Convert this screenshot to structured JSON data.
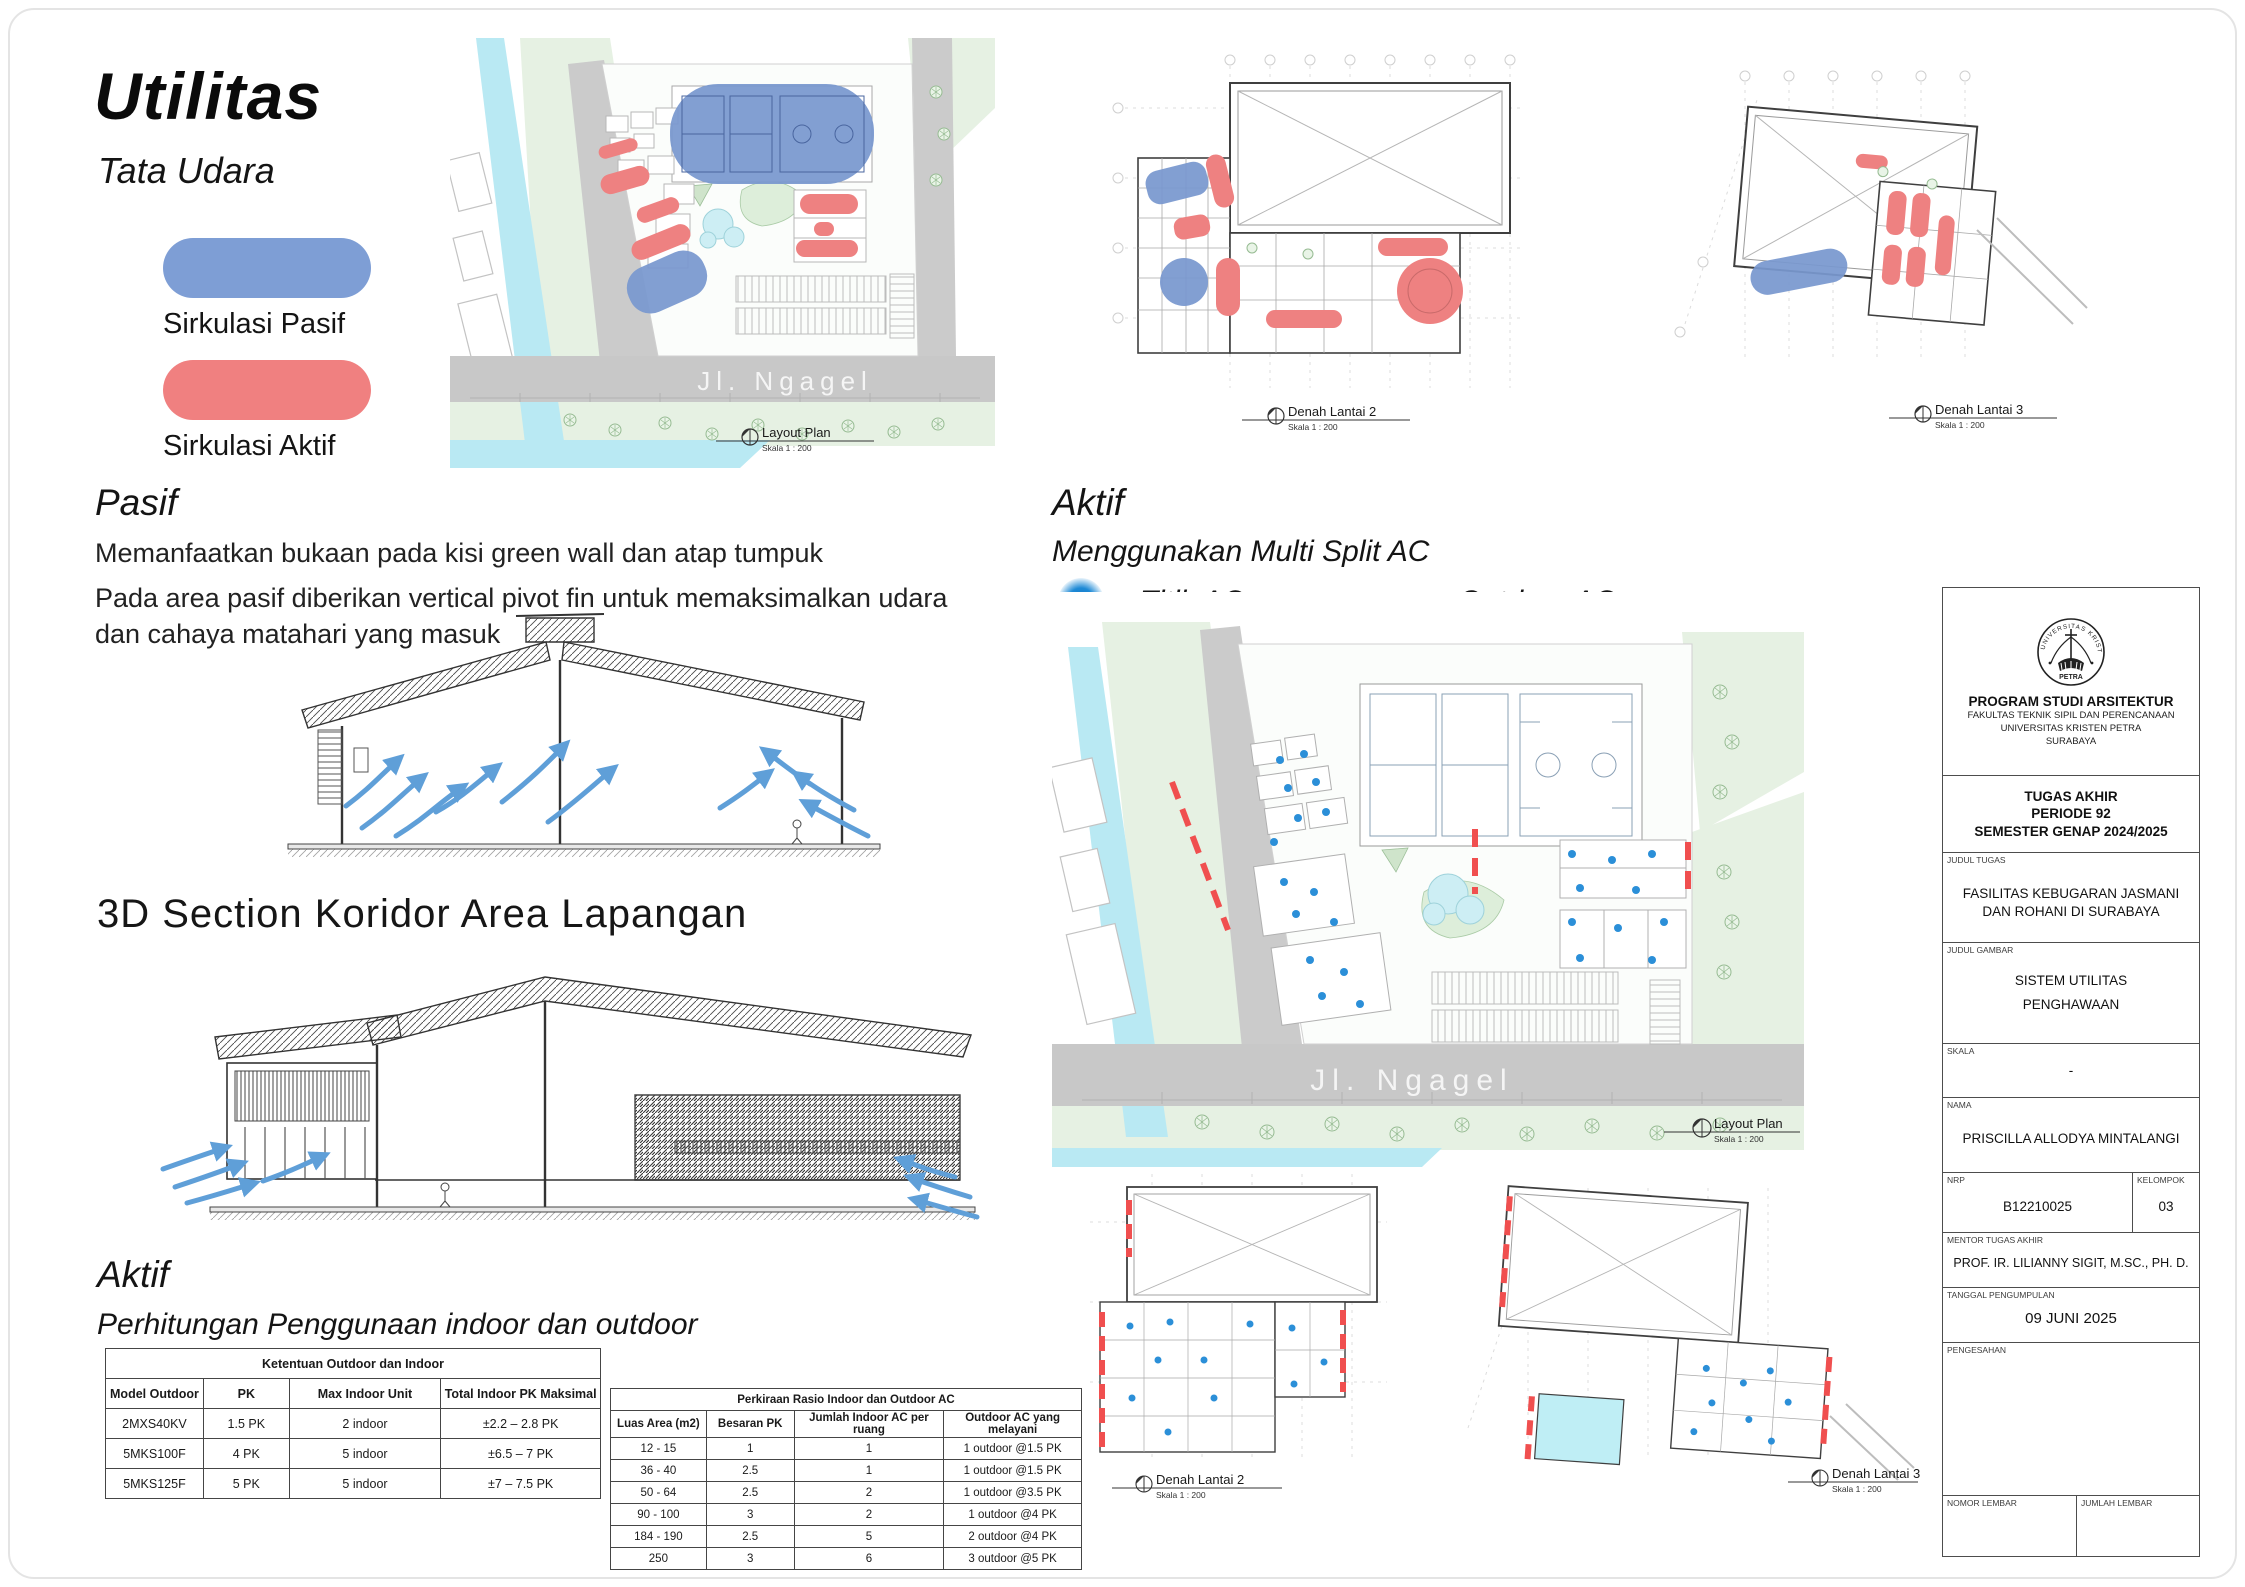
{
  "header": {
    "title": "Utilitas",
    "subtitle": "Tata Udara"
  },
  "legend": {
    "pasif_label": "Sirkulasi Pasif",
    "pasif_color": "#7E9ED5",
    "aktif_label": "Sirkulasi Aktif",
    "aktif_color": "#F08080"
  },
  "pasif_section": {
    "heading": "Pasif",
    "line1": "Memanfaatkan bukaan pada kisi green wall dan atap tumpuk",
    "line2": "Pada area pasif diberikan vertical pivot fin untuk memaksimalkan udara dan cahaya matahari yang masuk"
  },
  "section_3d": {
    "heading": "3D Section Koridor Area Lapangan"
  },
  "aktif_section": {
    "heading": "Aktif",
    "subtitle": "Menggunakan Multi Split AC",
    "titik_label": "Titik AC",
    "titik_color": "#1F86CF",
    "outdoor_label": "Outdoor AC",
    "outdoor_color": "#F15B5B"
  },
  "aktif_calc": {
    "heading": "Aktif",
    "subtitle": "Perhitungan Penggunaan indoor dan outdoor"
  },
  "table_ketentuan": {
    "title": "Ketentuan Outdoor dan Indoor",
    "headers": [
      "Model Outdoor",
      "PK",
      "Max Indoor Unit",
      "Total Indoor PK Maksimal"
    ],
    "rows": [
      [
        "2MXS40KV",
        "1.5 PK",
        "2 indoor",
        "±2.2 – 2.8 PK"
      ],
      [
        "5MKS100F",
        "4 PK",
        "5 indoor",
        "±6.5 – 7 PK"
      ],
      [
        "5MKS125F",
        "5 PK",
        "5 indoor",
        "±7 – 7.5 PK"
      ]
    ]
  },
  "table_rasio": {
    "title": "Perkiraan Rasio Indoor dan Outdoor AC",
    "headers": [
      "Luas Area (m2)",
      "Besaran PK",
      "Jumlah Indoor AC per ruang",
      "Outdoor AC yang melayani"
    ],
    "rows": [
      [
        "12 - 15",
        "1",
        "1",
        "1 outdoor @1.5 PK"
      ],
      [
        "36 - 40",
        "2.5",
        "1",
        "1 outdoor @1.5 PK"
      ],
      [
        "50 - 64",
        "2.5",
        "2",
        "1 outdoor @3.5 PK"
      ],
      [
        "90 - 100",
        "3",
        "2",
        "1 outdoor @4 PK"
      ],
      [
        "184 - 190",
        "2.5",
        "5",
        "2 outdoor @4 PK"
      ],
      [
        "250",
        "3",
        "6",
        "3 outdoor @5 PK"
      ]
    ]
  },
  "plans": {
    "layout_top": {
      "name": "Layout Plan",
      "scale": "Skala 1 : 200",
      "street": "Jl. Ngagel"
    },
    "denah2_top": {
      "name": "Denah Lantai 2",
      "scale": "Skala 1 : 200"
    },
    "denah3_top": {
      "name": "Denah Lantai 3",
      "scale": "Skala 1 : 200"
    },
    "layout_main": {
      "name": "Layout Plan",
      "scale": "Skala 1 : 200",
      "street": "Jl. Ngagel"
    },
    "denah2_bottom": {
      "name": "Denah Lantai 2",
      "scale": "Skala 1 : 200"
    },
    "denah3_bottom": {
      "name": "Denah Lantai 3",
      "scale": "Skala 1 : 200"
    }
  },
  "titleblock": {
    "program": "PROGRAM STUDI ARSITEKTUR",
    "faculty": "FAKULTAS TEKNIK SIPIL DAN PERENCANAAN",
    "university": "UNIVERSITAS KRISTEN PETRA",
    "city": "SURABAYA",
    "logo_text_top": "UNIVERSITAS KRISTEN",
    "logo_text_bottom": "PETRA",
    "project_line1": "TUGAS AKHIR",
    "project_line2": "PERIODE 92",
    "project_line3": "SEMESTER GENAP 2024/2025",
    "judul_tugas_label": "JUDUL TUGAS",
    "judul_tugas": "FASILITAS KEBUGARAN JASMANI DAN ROHANI DI SURABAYA",
    "judul_gambar_label": "JUDUL GAMBAR",
    "judul_gambar_line1": "SISTEM UTILITAS",
    "judul_gambar_line2": "PENGHAWAAN",
    "skala_label": "SKALA",
    "skala": "-",
    "nama_label": "NAMA",
    "nama": "PRISCILLA ALLODYA MINTALANGI",
    "nrp_label": "NRP",
    "nrp": "B12210025",
    "kelompok_label": "KELOMPOK",
    "kelompok": "03",
    "mentor_label": "MENTOR TUGAS AKHIR",
    "mentor": "PROF. IR. LILIANNY SIGIT, M.SC., PH. D.",
    "tanggal_label": "TANGGAL PENGUMPULAN",
    "tanggal": "09 JUNI 2025",
    "pengesahan_label": "PENGESAHAN",
    "nomor_label": "NOMOR LEMBAR",
    "jumlah_label": "JUMLAH LEMBAR"
  }
}
